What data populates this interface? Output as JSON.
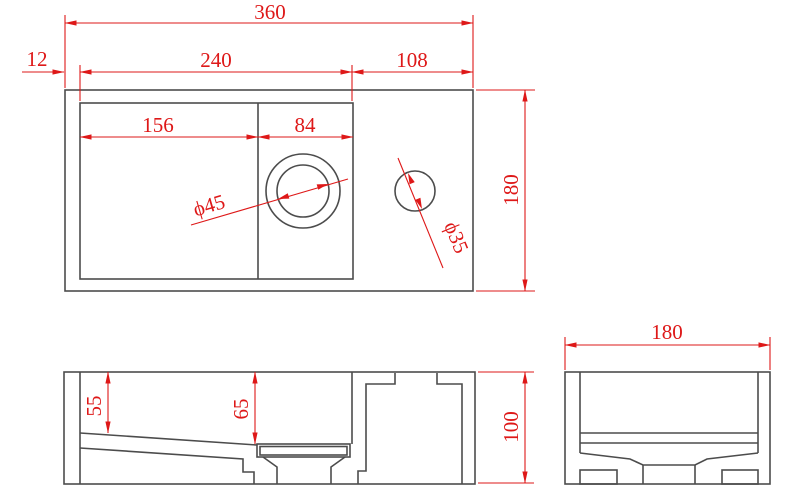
{
  "drawing": {
    "colors": {
      "dimension": "#de1818",
      "outline": "#4c4c4c",
      "background": "#ffffff"
    },
    "top_view": {
      "overall_width": "360",
      "rim_left_offset": "12",
      "basin_opening_width": "240",
      "tap_deck_width": "108",
      "basin_left_width": "156",
      "basin_right_width": "84",
      "drain_diameter": "ϕ45",
      "tap_hole_diameter": "ϕ35",
      "overall_depth": "180"
    },
    "front_view": {
      "basin_depth_left": "55",
      "basin_depth_right": "65",
      "overall_height": "100"
    },
    "side_view": {
      "overall_depth": "180"
    }
  }
}
